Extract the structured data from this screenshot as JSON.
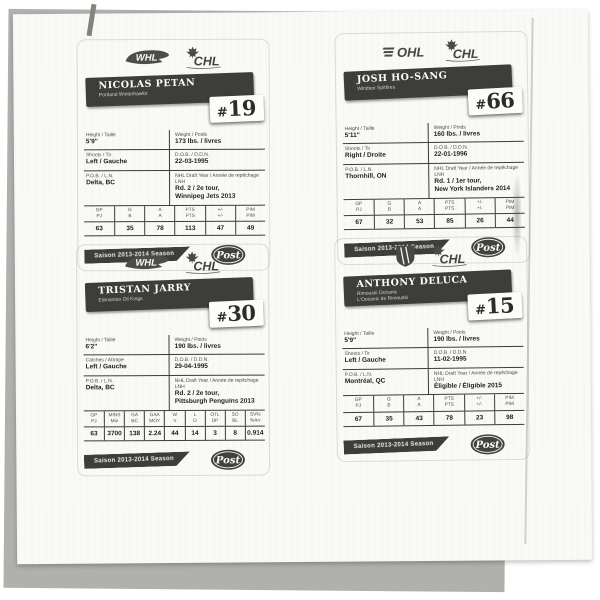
{
  "cards": [
    {
      "league": "whl",
      "league_text": "WHL",
      "chl_text": "CHL",
      "name": "NICOLAS PETAN",
      "team_line1": "Portland Winterhawks",
      "team_line2": "",
      "number": "#19",
      "info_rows": [
        {
          "ll": "Height / Taille",
          "lv": "5'9\"",
          "rl": "Weight / Poids",
          "rv": "173 lbs. / livres"
        },
        {
          "ll": "Shoots / Tir",
          "lv": "Left / Gauche",
          "rl": "D.O.B. / D.D.N.",
          "rv": "22-03-1995"
        },
        {
          "ll": "P.O.B. / L.N.",
          "lv": "Delta, BC",
          "rl": "NHL Draft Year / Année de repêchage LNH",
          "rv": "Rd. 2 / 2e tour,\nWinnipeg Jets 2013"
        }
      ],
      "stats_headers": [
        {
          "en": "GP",
          "fr": "PJ"
        },
        {
          "en": "G",
          "fr": "B"
        },
        {
          "en": "A",
          "fr": "A"
        },
        {
          "en": "PTS",
          "fr": "PTS"
        },
        {
          "en": "+/-",
          "fr": "+/-"
        },
        {
          "en": "PIM",
          "fr": "PIM"
        }
      ],
      "stats_values": [
        "63",
        "35",
        "78",
        "113",
        "47",
        "49"
      ],
      "season_banner": "Saison 2013-2014 Season",
      "post_text": "Post"
    },
    {
      "league": "ohl",
      "league_text": "OHL",
      "chl_text": "CHL",
      "name": "JOSH HO-SANG",
      "team_line1": "Windsor Spitfires",
      "team_line2": "",
      "number": "#66",
      "info_rows": [
        {
          "ll": "Height / Taille",
          "lv": "5'11\"",
          "rl": "Weight / Poids",
          "rv": "160 lbs. / livres"
        },
        {
          "ll": "Shoots / Tir",
          "lv": "Right / Droite",
          "rl": "D.O.B. / D.D.N.",
          "rv": "22-01-1996"
        },
        {
          "ll": "P.O.B. / L.N.",
          "lv": "Thornhill, ON",
          "rl": "NHL Draft Year / Année de repêchage LNH",
          "rv": "Rd. 1 / 1er tour,\nNew York Islanders 2014"
        }
      ],
      "stats_headers": [
        {
          "en": "GP",
          "fr": "PJ"
        },
        {
          "en": "G",
          "fr": "B"
        },
        {
          "en": "A",
          "fr": "A"
        },
        {
          "en": "PTS",
          "fr": "PTS"
        },
        {
          "en": "+/-",
          "fr": "+/-"
        },
        {
          "en": "PIM",
          "fr": "PIM"
        }
      ],
      "stats_values": [
        "67",
        "32",
        "53",
        "85",
        "26",
        "44"
      ],
      "season_banner": "Saison 2013-2014 Season",
      "post_text": "Post"
    },
    {
      "league": "whl",
      "league_text": "WHL",
      "chl_text": "CHL",
      "name": "TRISTAN JARRY",
      "team_line1": "Edmonton Oil Kings",
      "team_line2": "",
      "number": "#30",
      "info_rows": [
        {
          "ll": "Height / Taille",
          "lv": "6'2\"",
          "rl": "Weight / Poids",
          "rv": "190 lbs. / livres"
        },
        {
          "ll": "Catches / Attrape",
          "lv": "Left / Gauche",
          "rl": "D.O.B. / D.D.N.",
          "rv": "29-04-1995"
        },
        {
          "ll": "P.O.B. / L.N.",
          "lv": "Delta, BC",
          "rl": "NHL Draft Year / Année de repêchage LNH",
          "rv": "Rd. 2 / 2e tour,\nPittsburgh Penguins 2013"
        }
      ],
      "stats_headers": [
        {
          "en": "GP",
          "fr": "PJ"
        },
        {
          "en": "MINS",
          "fr": "Min"
        },
        {
          "en": "GA",
          "fr": "BC"
        },
        {
          "en": "GAA",
          "fr": "MOY"
        },
        {
          "en": "W",
          "fr": "V"
        },
        {
          "en": "L",
          "fr": "D"
        },
        {
          "en": "OTL",
          "fr": "DP"
        },
        {
          "en": "SO",
          "fr": "BL"
        },
        {
          "en": "SV%",
          "fr": "%Arr"
        }
      ],
      "stats_values": [
        "63",
        "3700",
        "138",
        "2.24",
        "44",
        "14",
        "3",
        "8",
        "0.914"
      ],
      "season_banner": "Saison 2013-2014 Season",
      "post_text": "Post"
    },
    {
      "league": "lhjmq",
      "league_text": "LHJMQ",
      "chl_text": "CHL",
      "name": "ANTHONY DELUCA",
      "team_line1": "Rimouski Océanic",
      "team_line2": "L'Océanic de Rimouski",
      "number": "#15",
      "info_rows": [
        {
          "ll": "Height / Taille",
          "lv": "5'9\"",
          "rl": "Weight / Poids",
          "rv": "190 lbs. / livres"
        },
        {
          "ll": "Shoots / Tir",
          "lv": "Left / Gauche",
          "rl": "D.O.B. / D.D.N.",
          "rv": "11-02-1995"
        },
        {
          "ll": "P.O.B. / L.N.",
          "lv": "Montréal, QC",
          "rl": "NHL Draft Year / Année de repêchage LNH",
          "rv": "Éligible / Éligible 2015"
        }
      ],
      "stats_headers": [
        {
          "en": "GP",
          "fr": "PJ"
        },
        {
          "en": "G",
          "fr": "B"
        },
        {
          "en": "A",
          "fr": "A"
        },
        {
          "en": "PTS",
          "fr": "PTS"
        },
        {
          "en": "+/-",
          "fr": "+/-"
        },
        {
          "en": "PIM",
          "fr": "PIM"
        }
      ],
      "stats_values": [
        "67",
        "35",
        "43",
        "78",
        "23",
        "98"
      ],
      "season_banner": "Saison 2013-2014 Season",
      "post_text": "Post"
    }
  ]
}
